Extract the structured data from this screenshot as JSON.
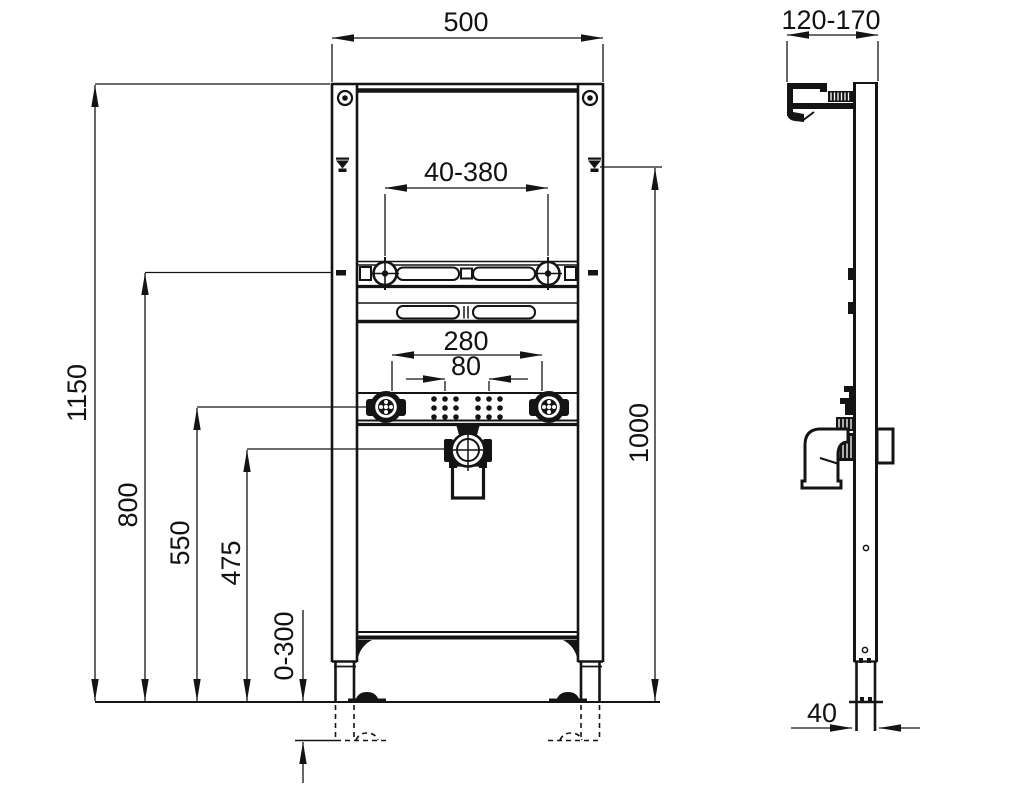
{
  "drawing": {
    "line_color": "#141414",
    "background": "#ffffff",
    "dimensions": {
      "front": {
        "overall_width": "500",
        "fixing_bolt_range": "40-380",
        "tap_bracket_span": "280",
        "tap_hole_spacing": "80",
        "frame_height": "1150",
        "upper_fixing_height": "1000",
        "crossbar_height": "800",
        "tap_rail_height": "550",
        "drain_height": "475",
        "foot_adjustment": "0-300"
      },
      "side": {
        "wall_bracket_range": "120-170",
        "profile_depth": "40"
      }
    }
  }
}
